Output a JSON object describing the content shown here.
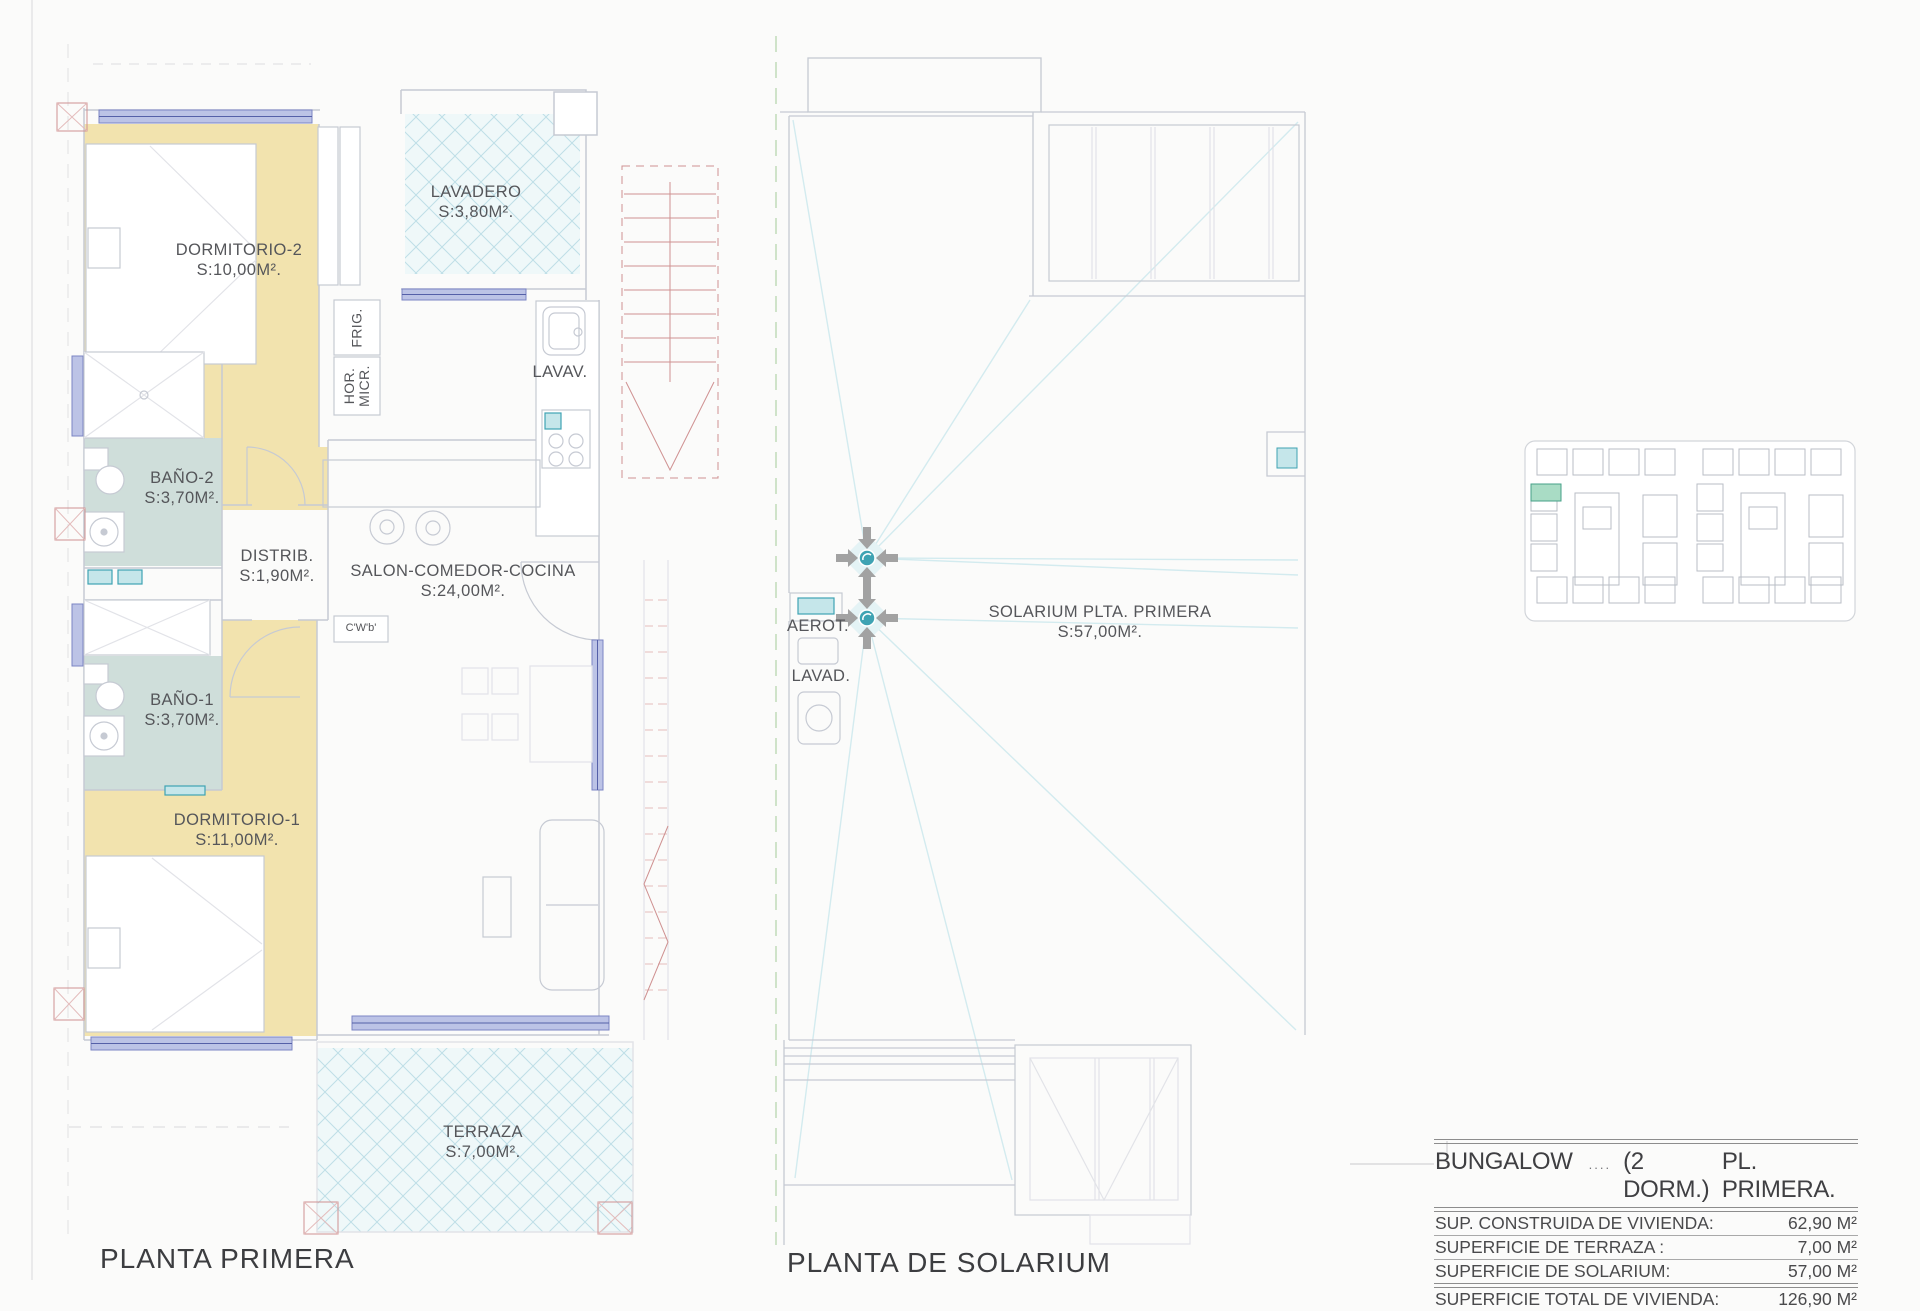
{
  "colors": {
    "paper": "#fbfbfa",
    "line": "#c6cad3",
    "line2": "#b3b8c2",
    "faint": "#e2e3e8",
    "ochre": "#f2e3ae",
    "bath": "#cfdeda",
    "tilefill": "#eff8f9",
    "tileline": "#bedee7",
    "window": "#7b84c4",
    "windowfill": "#bcc3e6",
    "red": "#cf9191",
    "redlight": "#e4bcbc",
    "text": "#55565a",
    "title": "#3c3d40",
    "tableline": "#8d8d8d",
    "teal": "#3fa3b3",
    "tealfill": "#c5e6ea",
    "arrow": "#a2a2a2",
    "slope": "#d3ebef",
    "dashgreen": "#cfe3c9",
    "highlight": "#a9dcc5",
    "highlightborder": "#46a188"
  },
  "plan_left": {
    "title": "PLANTA PRIMERA",
    "rooms": [
      {
        "name": "DORMITORIO-2",
        "area": "S:10,00M²."
      },
      {
        "name": "LAVADERO",
        "area": "S:3,80M²."
      },
      {
        "name": "BAÑO-2",
        "area": "S:3,70M²."
      },
      {
        "name": "DISTRIB.",
        "area": "S:1,90M²."
      },
      {
        "name": "SALON-COMEDOR-COCINA",
        "area": "S:24,00M²."
      },
      {
        "name": "BAÑO-1",
        "area": "S:3,70M²."
      },
      {
        "name": "DORMITORIO-1",
        "area": "S:11,00M²."
      },
      {
        "name": "TERRAZA",
        "area": "S:7,00M²."
      }
    ],
    "labels": {
      "frig": "FRIG.",
      "hor": "HOR.",
      "micr": "MICR.",
      "lavav": "LAVAV.",
      "cwb": "C'W'b'"
    }
  },
  "plan_right": {
    "title": "PLANTA DE SOLARIUM",
    "room": {
      "name": "SOLARIUM PLTA. PRIMERA",
      "area": "S:57,00M²."
    },
    "labels": {
      "aerot": "AEROT.",
      "lavad": "LAVAD."
    }
  },
  "summary_table": {
    "title_name": "BUNGALOW",
    "title_dots": "....",
    "title_mid": "(2 DORM.)",
    "title_right": "PL. PRIMERA.",
    "rows": [
      {
        "label": "SUP. CONSTRUIDA DE VIVIENDA:",
        "value": "62,90 M²"
      },
      {
        "label": "SUPERFICIE DE TERRAZA :",
        "value": "7,00 M²"
      },
      {
        "label": "SUPERFICIE  DE SOLARIUM:",
        "value": "57,00 M²"
      },
      {
        "label": "SUPERFICIE  TOTAL DE VIVIENDA:",
        "value": "126,90 M²"
      }
    ]
  }
}
